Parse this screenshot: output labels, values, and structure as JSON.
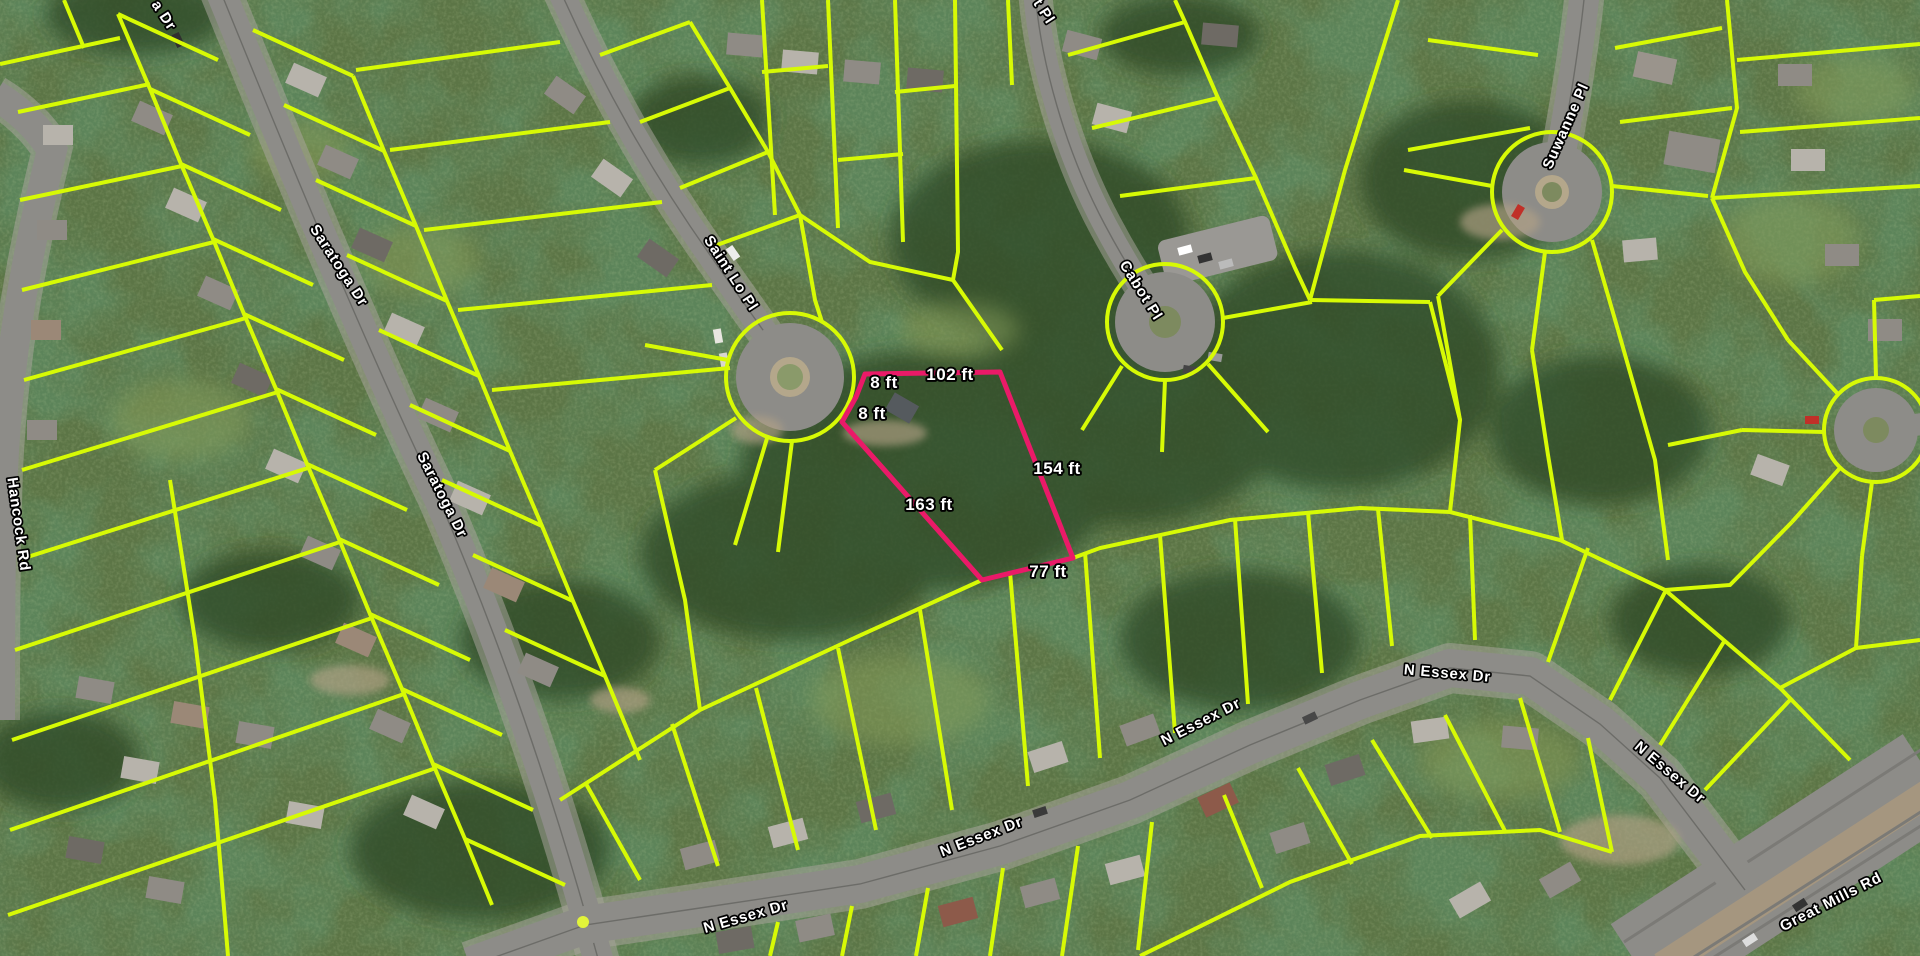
{
  "map": {
    "type": "aerial-parcel-viewer",
    "base_layer": "satellite",
    "parcel_line_color": "#d7fa05",
    "highlight_color": "#ea1a68",
    "label_color": "#ffffff",
    "label_outline_color": "#000000"
  },
  "street_labels": [
    {
      "text": "a Dr",
      "note": "clipped at top edge"
    },
    {
      "text": "Saratoga Dr"
    },
    {
      "text": "Saratoga Dr"
    },
    {
      "text": "Hancock Rd"
    },
    {
      "text": "Saint Lo Pl"
    },
    {
      "text": "t Pl",
      "note": "clipped at top edge"
    },
    {
      "text": "Cabot Pl"
    },
    {
      "text": "Suwanne Pl"
    },
    {
      "text": "N Essex Dr"
    },
    {
      "text": "N Essex Dr"
    },
    {
      "text": "N Essex Dr"
    },
    {
      "text": "N Essex Dr"
    },
    {
      "text": "N Essex Dr"
    },
    {
      "text": "Great Mills Rd"
    }
  ],
  "highlight_parcel": {
    "edge_labels": [
      "8 ft",
      "8 ft",
      "102 ft",
      "154 ft",
      "163 ft",
      "77 ft"
    ]
  }
}
